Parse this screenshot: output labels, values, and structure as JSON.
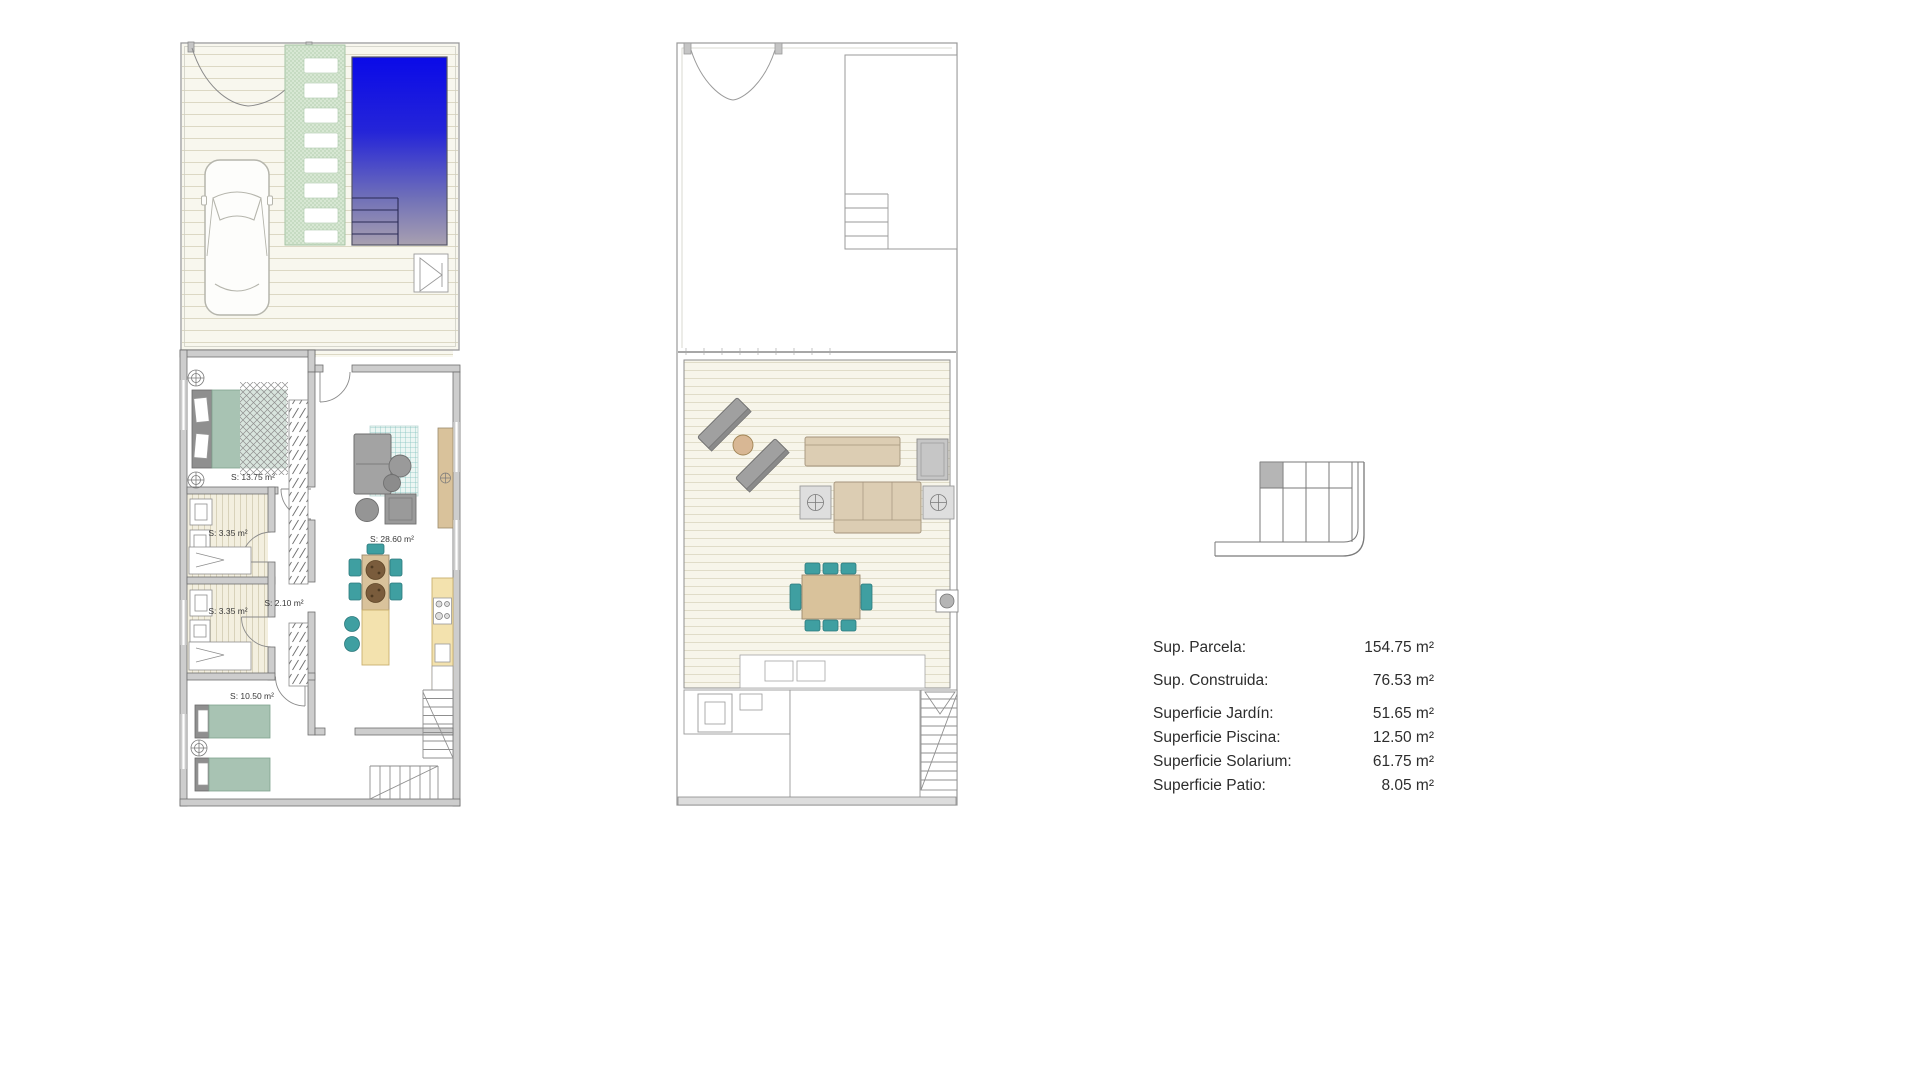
{
  "page": {
    "background": "#ffffff"
  },
  "plans": {
    "ground": {
      "name": "ground-floor-plan",
      "rooms": [
        {
          "id": "bedroom-1",
          "area_label": "S: 13.75 m²"
        },
        {
          "id": "bathroom-1",
          "area_label": "S: 3.35 m²"
        },
        {
          "id": "hall",
          "area_label": "S: 2.10 m²"
        },
        {
          "id": "bathroom-2",
          "area_label": "S: 3.35 m²"
        },
        {
          "id": "living-kitchen",
          "area_label": "S: 28.60 m²"
        },
        {
          "id": "bedroom-2",
          "area_label": "S: 10.50 m²"
        }
      ]
    },
    "solarium": {
      "name": "solarium-floor-plan"
    },
    "stair_detail": {
      "name": "staircase-section-detail"
    }
  },
  "summary": {
    "rows": [
      {
        "label": "Sup. Parcela:",
        "value": "154.75 m²"
      },
      {
        "label": "Sup. Construida:",
        "value": "76.53 m²"
      },
      {
        "label": "Superficie Jardín:",
        "value": "51.65 m²"
      },
      {
        "label": "Superficie Piscina:",
        "value": "12.50 m²"
      },
      {
        "label": "Superficie Solarium:",
        "value": "61.75 m²"
      },
      {
        "label": "Superficie Patio:",
        "value": "8.05 m²"
      }
    ]
  },
  "colors": {
    "pool_top": "#0a0ae8",
    "pool_bottom": "#a8a0b0",
    "path_green": "#d7e7d3",
    "furniture_green": "#a8c3b3",
    "teal": "#3f9fa1",
    "wood_tan": "#d9c29b",
    "counter_cream": "#f3e2ae",
    "sofa_gray": "#9b9b9b",
    "wall_gray": "#cdcdcd",
    "floor_stripe": "#f8f7ee",
    "text": "#3a3a3a"
  }
}
